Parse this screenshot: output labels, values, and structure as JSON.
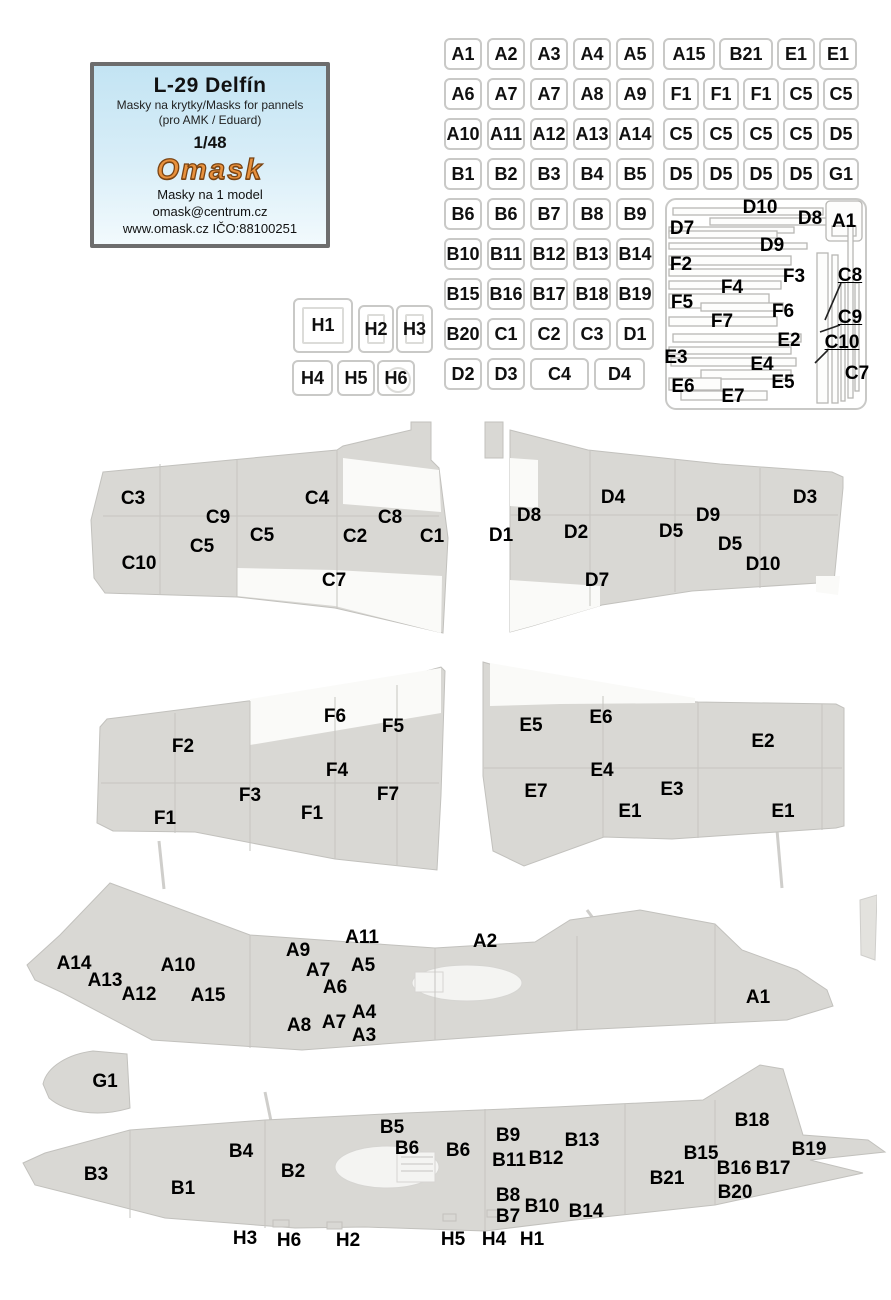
{
  "header": {
    "title": "L-29 Delfín",
    "subtitle": "Masky na krytky/Masks for pannels",
    "compatibility": "(pro AMK / Eduard)",
    "scale": "1/48",
    "brand": "Omask",
    "note": "Masky na 1 model",
    "email": "omask@centrum.cz",
    "website": "www.omask.cz IČO:88100251"
  },
  "colors": {
    "brand_orange": "#e8913d",
    "box_border": "#6d6d6d",
    "box_blue": "#c3e4f3",
    "part_gray": "#d9d8d4",
    "label_black": "#000000"
  },
  "grids": {
    "center": {
      "rows": [
        [
          "A1",
          "A2",
          "A3",
          "A4",
          "A5"
        ],
        [
          "A6",
          "A7",
          "A7",
          "A8",
          "A9"
        ],
        [
          "A10",
          "A11",
          "A12",
          "A13",
          "A14"
        ],
        [
          "B1",
          "B2",
          "B3",
          "B4",
          "B5"
        ],
        [
          "B6",
          "B6",
          "B7",
          "B8",
          "B9"
        ],
        [
          "B10",
          "B11",
          "B12",
          "B13",
          "B14"
        ],
        [
          "B15",
          "B16",
          "B17",
          "B18",
          "B19"
        ],
        [
          "B20",
          "C1",
          "C2",
          "C3",
          "D1"
        ],
        [
          {
            "t": "D2"
          },
          {
            "t": "D3"
          },
          {
            "t": "C4",
            "w": 59
          },
          {
            "t": "D4",
            "w": 51
          }
        ]
      ]
    },
    "right": {
      "rows": [
        [
          {
            "t": "A15",
            "w": 52
          },
          {
            "t": "B21",
            "w": 54
          },
          {
            "t": "E1",
            "w": 38
          },
          {
            "t": "E1",
            "w": 38
          }
        ],
        [
          "F1",
          "F1",
          "F1",
          "C5",
          "C5"
        ],
        [
          "C5",
          "C5",
          "C5",
          "C5",
          "D5"
        ],
        [
          "D5",
          "D5",
          "D5",
          "D5",
          "G1"
        ]
      ]
    },
    "h": {
      "cells": [
        {
          "t": "H1",
          "x": 293,
          "y": 298,
          "w": 60,
          "h": 55,
          "inner": "rect"
        },
        {
          "t": "H2",
          "x": 358,
          "y": 305,
          "w": 36,
          "h": 48,
          "inner": "rect"
        },
        {
          "t": "H3",
          "x": 396,
          "y": 305,
          "w": 37,
          "h": 48,
          "inner": "rect"
        },
        {
          "t": "H4",
          "x": 292,
          "y": 360,
          "w": 41,
          "h": 36
        },
        {
          "t": "H5",
          "x": 337,
          "y": 360,
          "w": 38,
          "h": 36
        },
        {
          "t": "H6",
          "x": 377,
          "y": 360,
          "w": 38,
          "h": 36,
          "inner": "circle"
        }
      ]
    }
  },
  "strip_panel": {
    "labels": [
      {
        "t": "D10",
        "x": 760,
        "y": 208
      },
      {
        "t": "D8",
        "x": 810,
        "y": 219
      },
      {
        "t": "A1",
        "x": 844,
        "y": 222
      },
      {
        "t": "D7",
        "x": 682,
        "y": 229
      },
      {
        "t": "D9",
        "x": 772,
        "y": 246
      },
      {
        "t": "F2",
        "x": 681,
        "y": 265
      },
      {
        "t": "F3",
        "x": 794,
        "y": 277
      },
      {
        "t": "F4",
        "x": 732,
        "y": 288
      },
      {
        "t": "F5",
        "x": 682,
        "y": 303
      },
      {
        "t": "F6",
        "x": 783,
        "y": 312
      },
      {
        "t": "F7",
        "x": 722,
        "y": 322
      },
      {
        "t": "E2",
        "x": 789,
        "y": 341
      },
      {
        "t": "E3",
        "x": 676,
        "y": 358
      },
      {
        "t": "E4",
        "x": 762,
        "y": 365
      },
      {
        "t": "E5",
        "x": 783,
        "y": 383
      },
      {
        "t": "E6",
        "x": 683,
        "y": 387
      },
      {
        "t": "E7",
        "x": 733,
        "y": 397
      },
      {
        "t": "C8",
        "x": 850,
        "y": 276,
        "u": true
      },
      {
        "t": "C9",
        "x": 850,
        "y": 318,
        "u": true
      },
      {
        "t": "C10",
        "x": 842,
        "y": 343,
        "u": true
      },
      {
        "t": "C7",
        "x": 857,
        "y": 374
      }
    ]
  },
  "diagrams": {
    "wing_top_left": {
      "labels": [
        {
          "t": "C3",
          "x": 133,
          "y": 499
        },
        {
          "t": "C4",
          "x": 317,
          "y": 499
        },
        {
          "t": "C9",
          "x": 218,
          "y": 518
        },
        {
          "t": "C5",
          "x": 262,
          "y": 536
        },
        {
          "t": "C2",
          "x": 355,
          "y": 537
        },
        {
          "t": "C8",
          "x": 390,
          "y": 518
        },
        {
          "t": "C1",
          "x": 432,
          "y": 537
        },
        {
          "t": "C5",
          "x": 202,
          "y": 547
        },
        {
          "t": "C10",
          "x": 139,
          "y": 564
        },
        {
          "t": "C7",
          "x": 334,
          "y": 581
        }
      ]
    },
    "wing_top_right": {
      "labels": [
        {
          "t": "D4",
          "x": 613,
          "y": 498
        },
        {
          "t": "D3",
          "x": 805,
          "y": 498
        },
        {
          "t": "D8",
          "x": 529,
          "y": 516
        },
        {
          "t": "D9",
          "x": 708,
          "y": 516
        },
        {
          "t": "D1",
          "x": 501,
          "y": 536
        },
        {
          "t": "D2",
          "x": 576,
          "y": 533
        },
        {
          "t": "D5",
          "x": 671,
          "y": 532
        },
        {
          "t": "D5",
          "x": 730,
          "y": 545
        },
        {
          "t": "D10",
          "x": 763,
          "y": 565
        },
        {
          "t": "D7",
          "x": 597,
          "y": 581
        }
      ]
    },
    "wing_bottom_left": {
      "labels": [
        {
          "t": "F6",
          "x": 335,
          "y": 717
        },
        {
          "t": "F5",
          "x": 393,
          "y": 727
        },
        {
          "t": "F2",
          "x": 183,
          "y": 747
        },
        {
          "t": "F4",
          "x": 337,
          "y": 771
        },
        {
          "t": "F3",
          "x": 250,
          "y": 796
        },
        {
          "t": "F7",
          "x": 388,
          "y": 795
        },
        {
          "t": "F1",
          "x": 312,
          "y": 814
        },
        {
          "t": "F1",
          "x": 165,
          "y": 819
        }
      ]
    },
    "wing_bottom_right": {
      "labels": [
        {
          "t": "E5",
          "x": 531,
          "y": 726
        },
        {
          "t": "E6",
          "x": 601,
          "y": 718
        },
        {
          "t": "E2",
          "x": 763,
          "y": 742
        },
        {
          "t": "E4",
          "x": 602,
          "y": 771
        },
        {
          "t": "E7",
          "x": 536,
          "y": 792
        },
        {
          "t": "E3",
          "x": 672,
          "y": 790
        },
        {
          "t": "E1",
          "x": 630,
          "y": 812
        },
        {
          "t": "E1",
          "x": 783,
          "y": 812
        }
      ]
    },
    "fuselage_top": {
      "labels": [
        {
          "t": "A14",
          "x": 74,
          "y": 964
        },
        {
          "t": "A13",
          "x": 105,
          "y": 981
        },
        {
          "t": "A12",
          "x": 139,
          "y": 995
        },
        {
          "t": "A10",
          "x": 178,
          "y": 966
        },
        {
          "t": "A15",
          "x": 208,
          "y": 996
        },
        {
          "t": "A9",
          "x": 298,
          "y": 951
        },
        {
          "t": "A11",
          "x": 362,
          "y": 938
        },
        {
          "t": "A7",
          "x": 318,
          "y": 971
        },
        {
          "t": "A5",
          "x": 363,
          "y": 966
        },
        {
          "t": "A6",
          "x": 335,
          "y": 988
        },
        {
          "t": "A8",
          "x": 299,
          "y": 1026
        },
        {
          "t": "A7",
          "x": 334,
          "y": 1023
        },
        {
          "t": "A4",
          "x": 364,
          "y": 1013
        },
        {
          "t": "A3",
          "x": 364,
          "y": 1036
        },
        {
          "t": "A2",
          "x": 485,
          "y": 942
        },
        {
          "t": "A1",
          "x": 758,
          "y": 998
        }
      ]
    },
    "fuselage_bottom": {
      "labels": [
        {
          "t": "G1",
          "x": 105,
          "y": 1082
        },
        {
          "t": "B3",
          "x": 96,
          "y": 1175
        },
        {
          "t": "B1",
          "x": 183,
          "y": 1189
        },
        {
          "t": "B4",
          "x": 241,
          "y": 1152
        },
        {
          "t": "B2",
          "x": 293,
          "y": 1172
        },
        {
          "t": "B5",
          "x": 392,
          "y": 1128
        },
        {
          "t": "B6",
          "x": 407,
          "y": 1149
        },
        {
          "t": "B6",
          "x": 458,
          "y": 1151
        },
        {
          "t": "B9",
          "x": 508,
          "y": 1136
        },
        {
          "t": "B13",
          "x": 582,
          "y": 1141
        },
        {
          "t": "B11",
          "x": 509,
          "y": 1161
        },
        {
          "t": "B12",
          "x": 546,
          "y": 1159
        },
        {
          "t": "B8",
          "x": 508,
          "y": 1196
        },
        {
          "t": "B10",
          "x": 542,
          "y": 1207
        },
        {
          "t": "B7",
          "x": 508,
          "y": 1217
        },
        {
          "t": "B14",
          "x": 586,
          "y": 1212
        },
        {
          "t": "B21",
          "x": 667,
          "y": 1179
        },
        {
          "t": "B15",
          "x": 701,
          "y": 1154
        },
        {
          "t": "B16",
          "x": 734,
          "y": 1169
        },
        {
          "t": "B17",
          "x": 773,
          "y": 1169
        },
        {
          "t": "B18",
          "x": 752,
          "y": 1121
        },
        {
          "t": "B19",
          "x": 809,
          "y": 1150
        },
        {
          "t": "B20",
          "x": 735,
          "y": 1193
        },
        {
          "t": "H3",
          "x": 245,
          "y": 1239
        },
        {
          "t": "H6",
          "x": 289,
          "y": 1241
        },
        {
          "t": "H2",
          "x": 348,
          "y": 1241
        },
        {
          "t": "H5",
          "x": 453,
          "y": 1240
        },
        {
          "t": "H4",
          "x": 494,
          "y": 1240
        },
        {
          "t": "H1",
          "x": 532,
          "y": 1240
        }
      ]
    }
  }
}
